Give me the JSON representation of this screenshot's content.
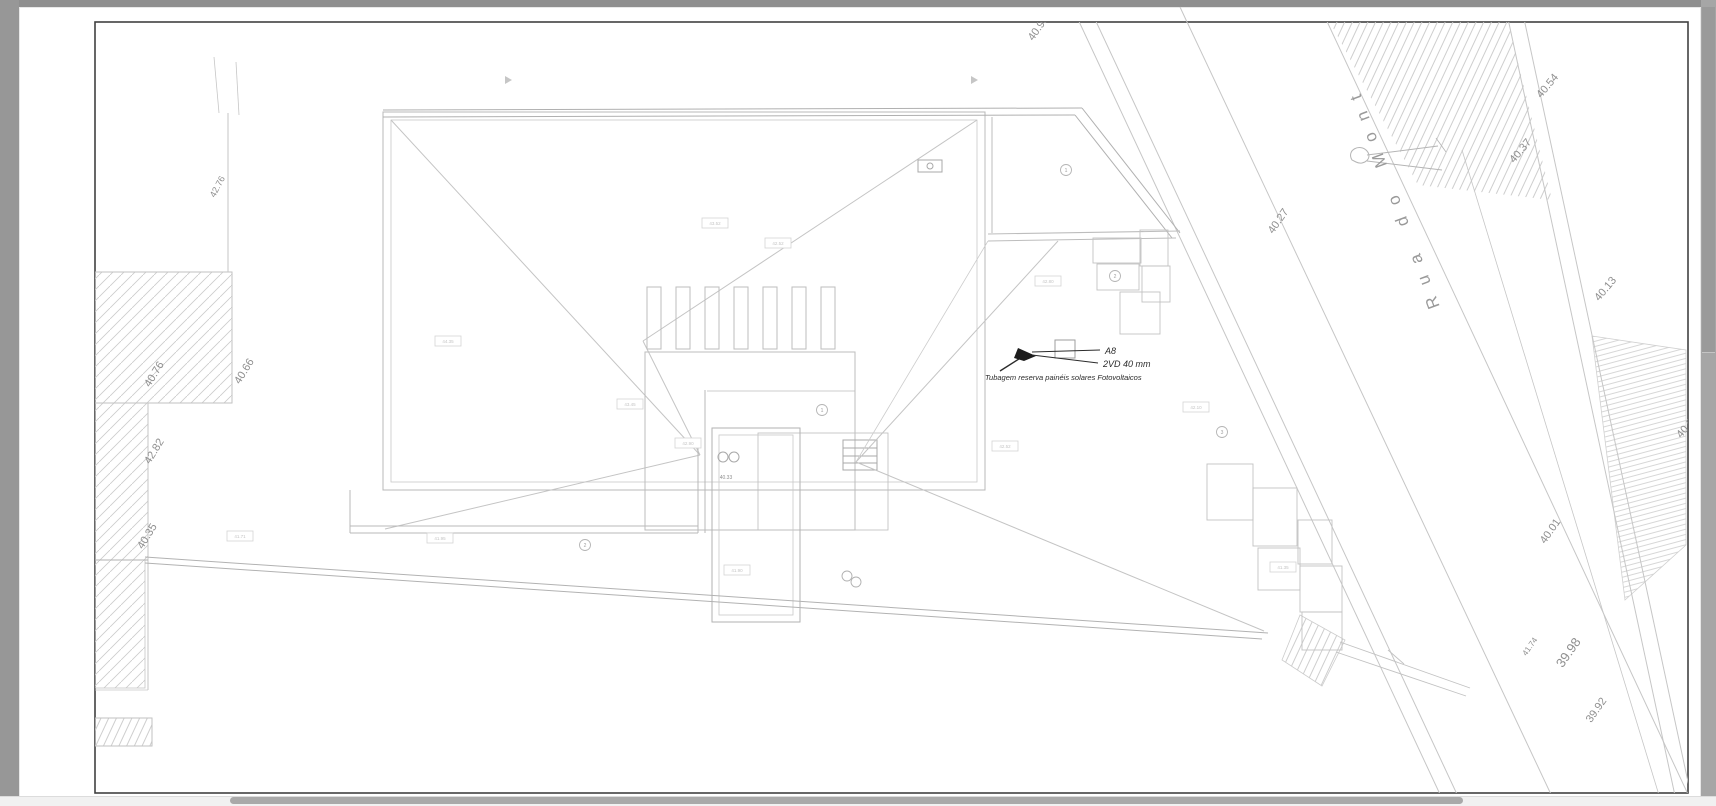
{
  "app": {
    "background": "#9b9b9b",
    "page_color": "#ffffff",
    "frame_color": "#414141",
    "line_color": "#c6c6c6"
  },
  "street_label": {
    "text": "Rua do Mont"
  },
  "annotation": {
    "label": "A8",
    "pipe": "2VD 40 mm",
    "note": "Tubagem reserva painéis solares Fotovoltaicos"
  },
  "elevation_labels": [
    {
      "text": "40.98",
      "x": 1041,
      "y": 30,
      "rot": -55,
      "size": 11
    },
    {
      "text": "42.76",
      "x": 220,
      "y": 188,
      "rot": -62,
      "size": 9
    },
    {
      "text": "40.76",
      "x": 157,
      "y": 376,
      "rot": -58,
      "size": 11
    },
    {
      "text": "40.66",
      "x": 247,
      "y": 373,
      "rot": -58,
      "size": 11
    },
    {
      "text": "42.82",
      "x": 157,
      "y": 453,
      "rot": -58,
      "size": 11
    },
    {
      "text": "40.35",
      "x": 150,
      "y": 538,
      "rot": -58,
      "size": 11
    },
    {
      "text": "40.27",
      "x": 1281,
      "y": 223,
      "rot": -55,
      "size": 11
    },
    {
      "text": "40.54",
      "x": 1550,
      "y": 88,
      "rot": -50,
      "size": 11
    },
    {
      "text": "40.37",
      "x": 1523,
      "y": 153,
      "rot": -50,
      "size": 11
    },
    {
      "text": "40.13",
      "x": 1608,
      "y": 291,
      "rot": -50,
      "size": 11
    },
    {
      "text": "40.07",
      "x": 1690,
      "y": 428,
      "rot": -50,
      "size": 11
    },
    {
      "text": "40.01",
      "x": 1553,
      "y": 533,
      "rot": -55,
      "size": 11
    },
    {
      "text": "41.74",
      "x": 1532,
      "y": 648,
      "rot": -55,
      "size": 8
    },
    {
      "text": "39.98",
      "x": 1572,
      "y": 655,
      "rot": -55,
      "size": 13
    },
    {
      "text": "39.92",
      "x": 1599,
      "y": 712,
      "rot": -55,
      "size": 11
    },
    {
      "text": "40.33",
      "x": 726,
      "y": 479,
      "rot": 0,
      "size": 5
    }
  ],
  "survey_tags": [
    {
      "text": "43.52",
      "x": 715,
      "y": 223
    },
    {
      "text": "42.52",
      "x": 778,
      "y": 243
    },
    {
      "text": "44.35",
      "x": 448,
      "y": 341
    },
    {
      "text": "43.45",
      "x": 630,
      "y": 404
    },
    {
      "text": "42.90",
      "x": 688,
      "y": 443
    },
    {
      "text": "42.80",
      "x": 1048,
      "y": 281
    },
    {
      "text": "42.52",
      "x": 1005,
      "y": 446
    },
    {
      "text": "41.95",
      "x": 440,
      "y": 538
    },
    {
      "text": "41.71",
      "x": 240,
      "y": 536
    },
    {
      "text": "41.90",
      "x": 737,
      "y": 570
    },
    {
      "text": "41.35",
      "x": 1283,
      "y": 567
    },
    {
      "text": "42.10",
      "x": 1196,
      "y": 407
    }
  ],
  "markers": [
    {
      "text": "1",
      "x": 1066,
      "y": 170
    },
    {
      "text": "2",
      "x": 1115,
      "y": 276
    },
    {
      "text": "1",
      "x": 822,
      "y": 410
    },
    {
      "text": "3",
      "x": 1222,
      "y": 432
    },
    {
      "text": "2",
      "x": 585,
      "y": 545
    }
  ]
}
